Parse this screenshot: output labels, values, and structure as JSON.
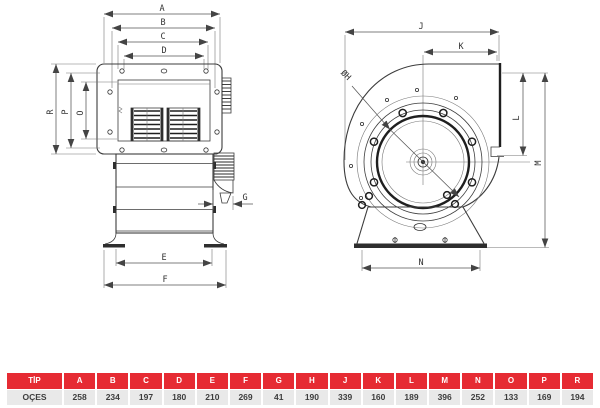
{
  "drawing": {
    "labels": {
      "A": "A",
      "B": "B",
      "C": "C",
      "D": "D",
      "E": "E",
      "F": "F",
      "G": "G",
      "H": "ØH",
      "J": "J",
      "K": "K",
      "L": "L",
      "M": "M",
      "N": "N",
      "O": "O",
      "P": "P",
      "R": "R"
    }
  },
  "table": {
    "columns": [
      "TİP",
      "A",
      "B",
      "C",
      "D",
      "E",
      "F",
      "G",
      "H",
      "J",
      "K",
      "L",
      "M",
      "N",
      "O",
      "P",
      "R"
    ],
    "row": {
      "label": "OÇES",
      "values": [
        "258",
        "234",
        "197",
        "180",
        "210",
        "269",
        "41",
        "190",
        "339",
        "160",
        "189",
        "396",
        "252",
        "133",
        "169",
        "194"
      ]
    }
  },
  "colors": {
    "header_red": "#e62b33",
    "row_gray": "#e9e9e9",
    "line_dark": "#3c3c3c"
  }
}
